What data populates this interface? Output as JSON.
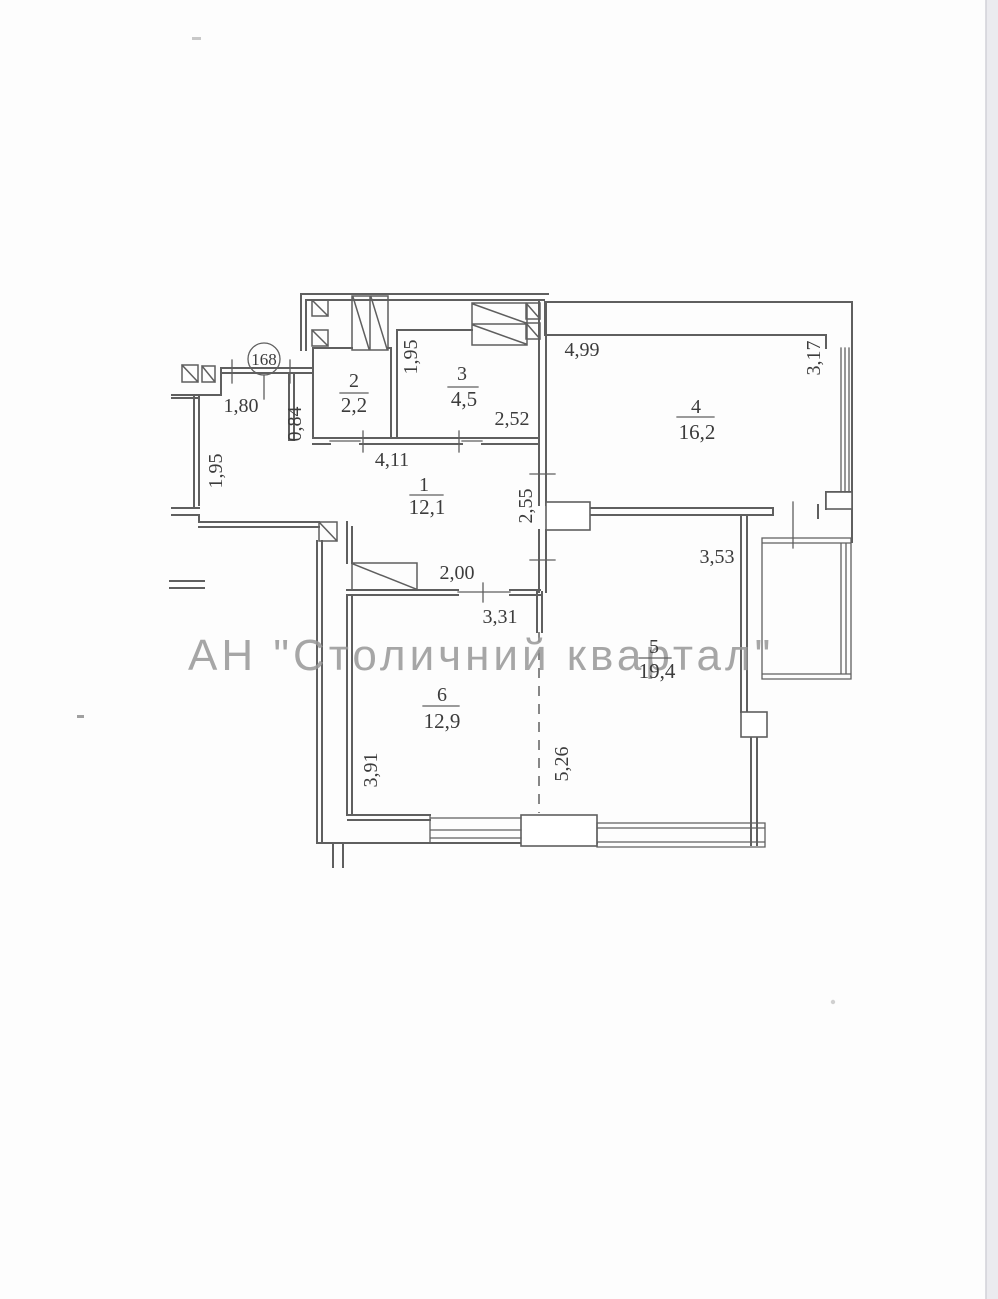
{
  "plan": {
    "apartment_number": "168",
    "watermark": "АН \"Столичний квартал\"",
    "rooms": [
      {
        "number": "1",
        "area": "12,1"
      },
      {
        "number": "2",
        "area": "2,2"
      },
      {
        "number": "3",
        "area": "4,5"
      },
      {
        "number": "4",
        "area": "16,2"
      },
      {
        "number": "5",
        "area": "19,4"
      },
      {
        "number": "6",
        "area": "12,9"
      }
    ],
    "dimensions": {
      "entry_width": "1,80",
      "entry_wall": "0,84",
      "hall_left_depth": "1,95",
      "room3_left_depth": "1,95",
      "room3_width": "2,52",
      "hall_width": "4,11",
      "room4_width": "4,99",
      "room4_depth": "3,17",
      "hall_room5_wall": "2,55",
      "room6_opening": "2,00",
      "room6_width": "3,31",
      "room5_width": "3,53",
      "room6_depth": "3,91",
      "room5_depth": "5,26"
    },
    "colors": {
      "wall_line": "#5f5f5f",
      "label_text": "#3c3c3c",
      "watermark_gray": "#989898",
      "page_edge": "#d2d2d8"
    }
  }
}
